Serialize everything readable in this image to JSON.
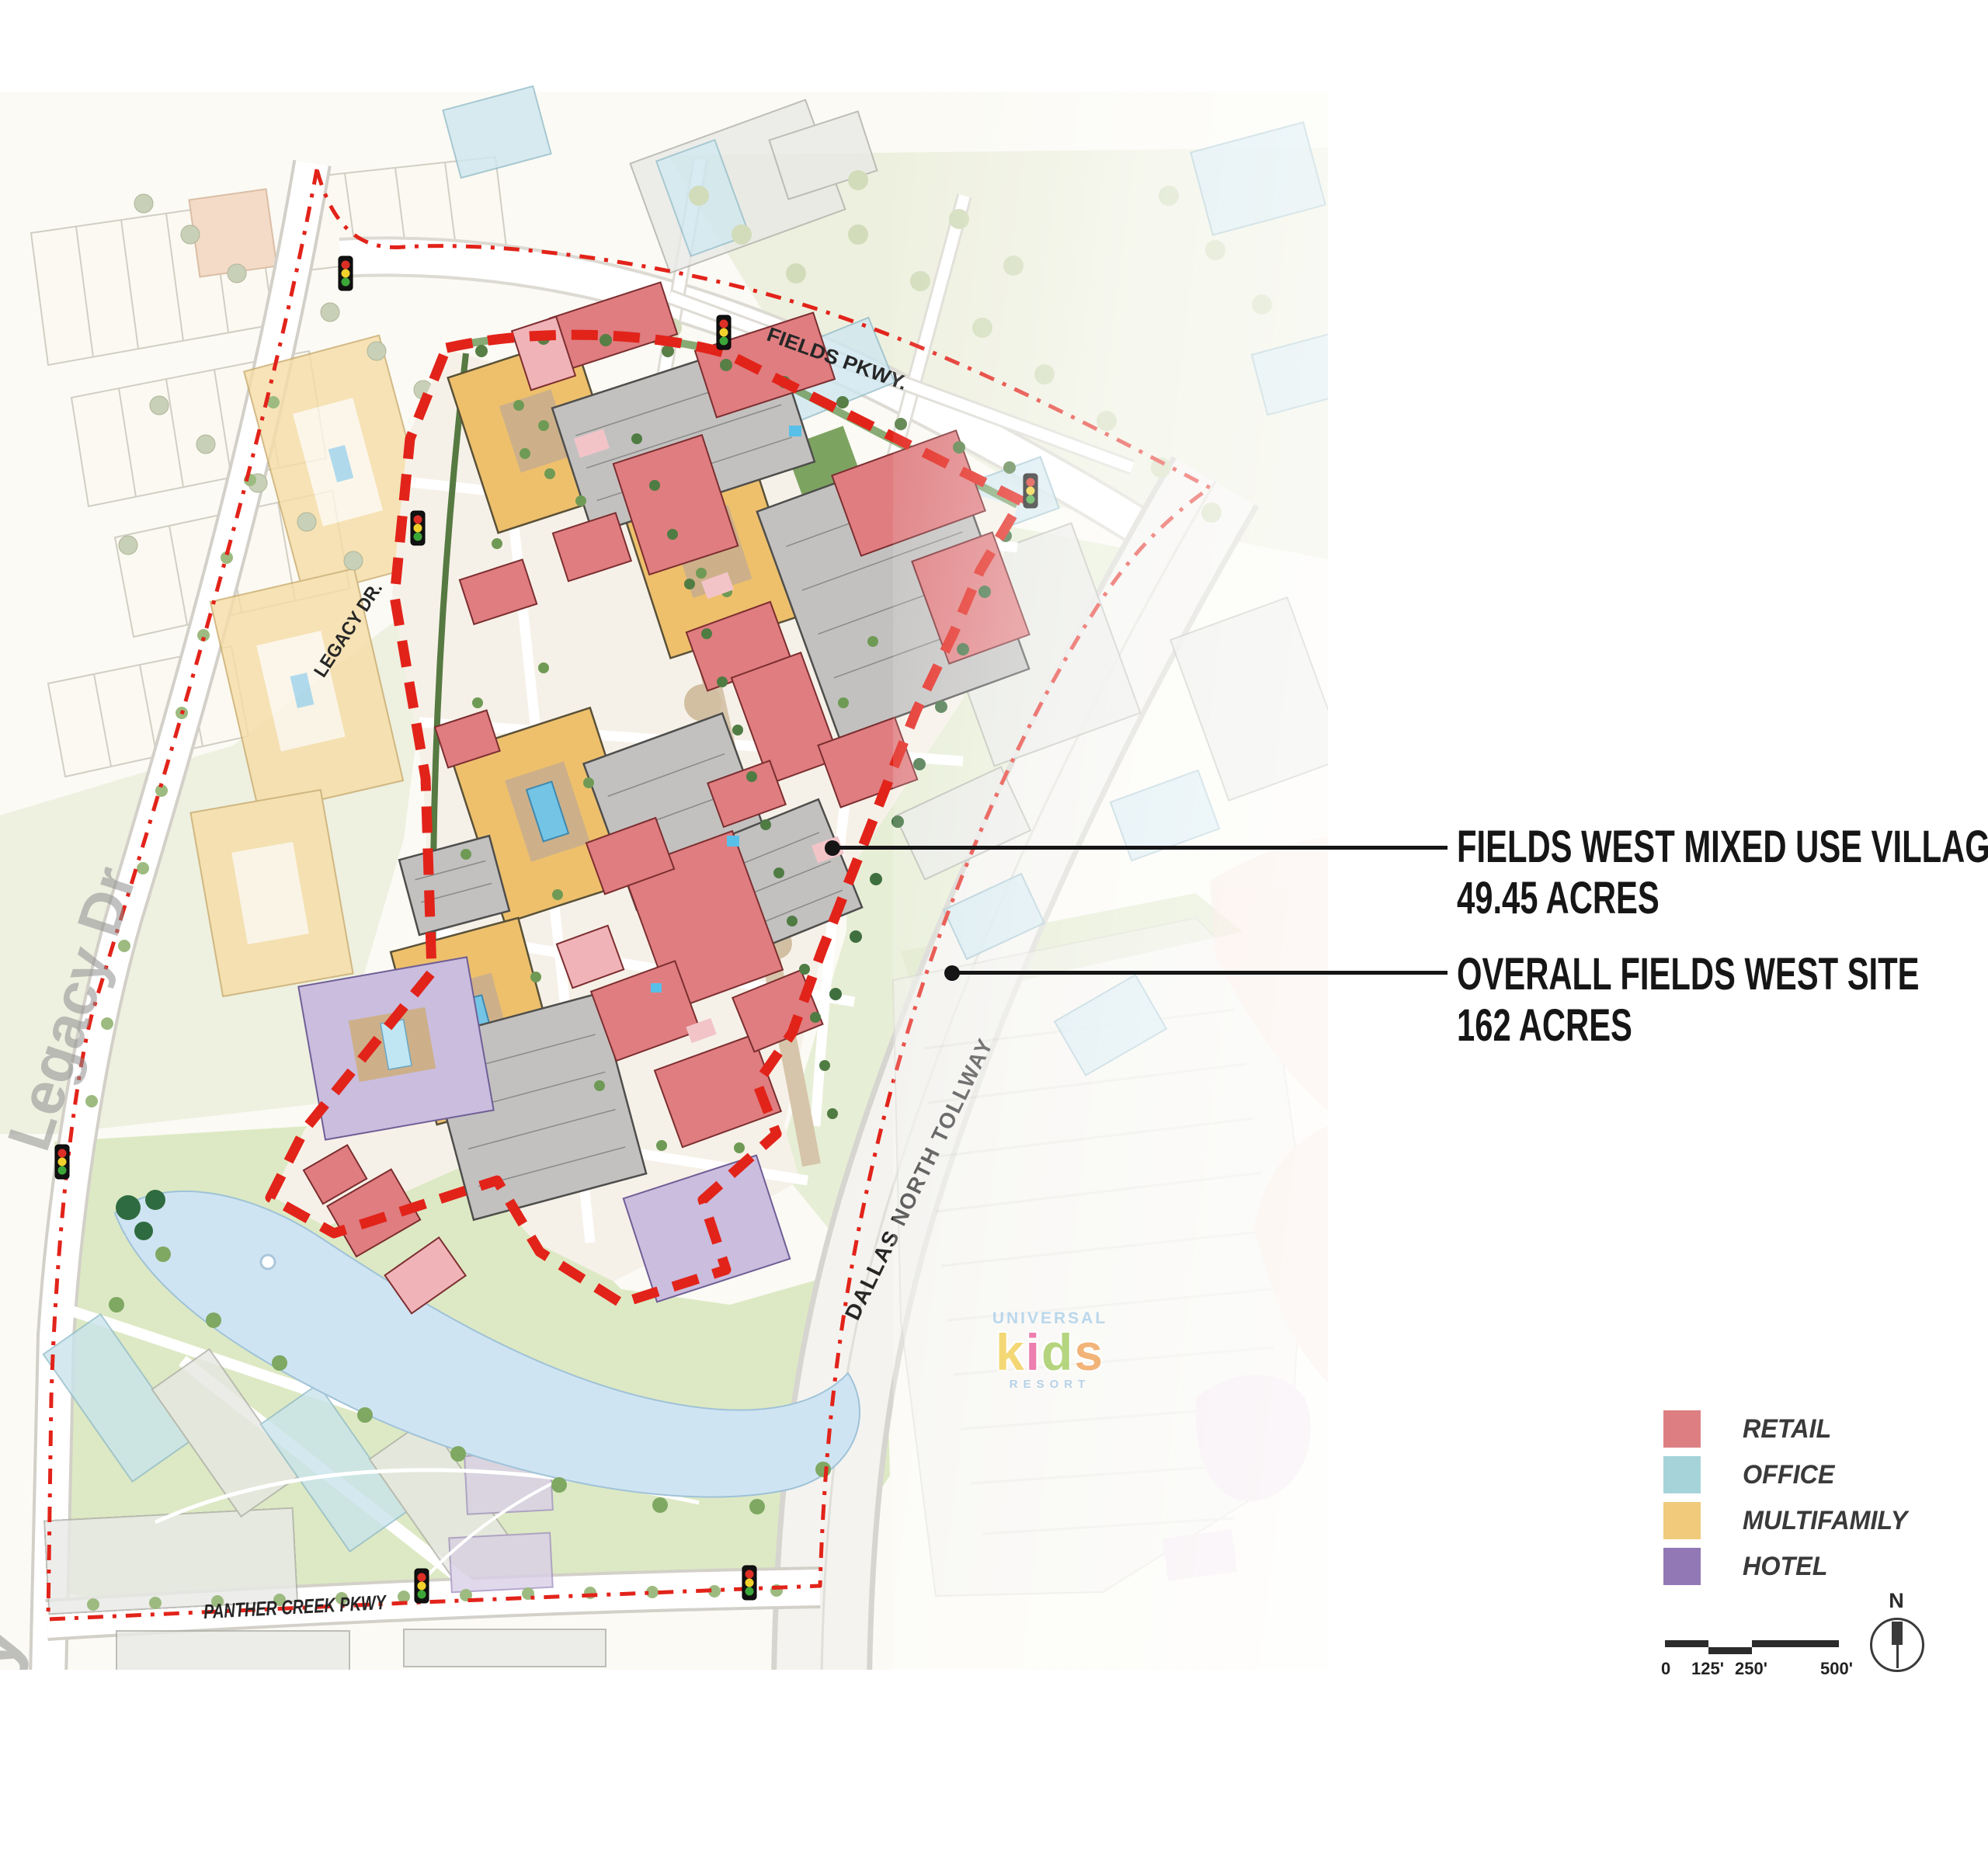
{
  "callouts": {
    "village": {
      "title": "FIELDS WEST MIXED USE VILLAGE",
      "acreage": "49.45 ACRES"
    },
    "overall": {
      "title": "OVERALL FIELDS WEST SITE",
      "acreage": "162 ACRES"
    }
  },
  "legend": {
    "items": [
      {
        "label": "RETAIL",
        "color": "#DD7F82",
        "swatch_style": "background:#DD7F82"
      },
      {
        "label": "OFFICE",
        "color": "#A6D3DA",
        "swatch_style": "background:#A6D3DA"
      },
      {
        "label": "MULTIFAMILY",
        "color": "#F1CA7B",
        "swatch_style": "background:#F1CA7B"
      },
      {
        "label": "HOTEL",
        "color": "#9279B5",
        "swatch_style": "background:#9279B5"
      }
    ]
  },
  "scale_bar": {
    "ticks": [
      "0",
      "125'",
      "250'",
      "500'"
    ]
  },
  "north_arrow": {
    "label": "N"
  },
  "map": {
    "boundary_color": "#E2231A",
    "road_labels": {
      "fields_pkwy": "FIELDS PKWY.",
      "legacy_dr": "LEGACY DR.",
      "legacy_watermark": "Legacy Dr",
      "legacy_watermark_partial": "y",
      "dallas_north_tollway": "DALLAS NORTH TOLLWAY",
      "panther_creek_pkwy": "PANTHER CREEK PKWY"
    },
    "resort_logo": {
      "brand": "UNIVERSAL",
      "letters": [
        {
          "ch": "k",
          "style": "color:#F2CF54"
        },
        {
          "ch": "i",
          "style": "color:#EA5F9D"
        },
        {
          "ch": "d",
          "style": "color:#A3CB60"
        },
        {
          "ch": "s",
          "style": "color:#F0A259"
        }
      ],
      "suffix": "RESORT"
    }
  }
}
